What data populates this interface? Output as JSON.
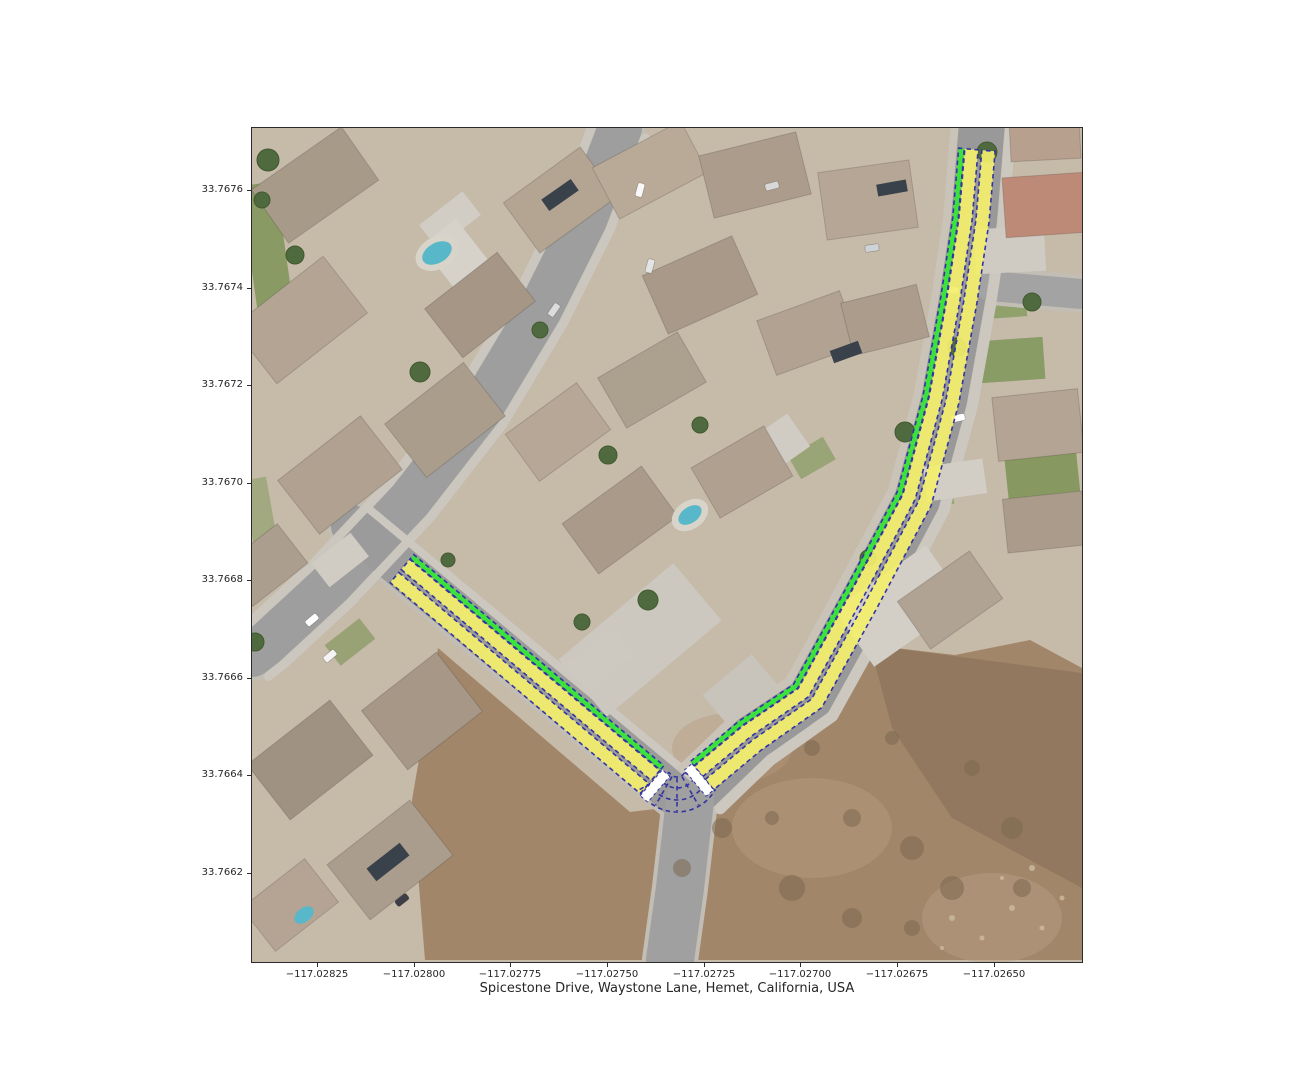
{
  "title": {
    "text": "Spicestone Drive, Waystone Lane, Hemet, California, USA"
  },
  "map": {
    "left": 252,
    "top": 128,
    "width": 830,
    "height": 834
  },
  "axes": {
    "tick_len": 4,
    "x_ticks": [
      {
        "px": 65,
        "label": "−117.02825"
      },
      {
        "px": 162,
        "label": "−117.02800"
      },
      {
        "px": 258,
        "label": "−117.02775"
      },
      {
        "px": 355,
        "label": "−117.02750"
      },
      {
        "px": 452,
        "label": "−117.02725"
      },
      {
        "px": 548,
        "label": "−117.02700"
      },
      {
        "px": 645,
        "label": "−117.02675"
      },
      {
        "px": 742,
        "label": "−117.02650"
      }
    ],
    "y_ticks": [
      {
        "px": 62,
        "label": "33.7676"
      },
      {
        "px": 159.5,
        "label": "33.7674"
      },
      {
        "px": 257,
        "label": "33.7672"
      },
      {
        "px": 354.5,
        "label": "33.7670"
      },
      {
        "px": 452,
        "label": "33.7668"
      },
      {
        "px": 549.5,
        "label": "33.7666"
      },
      {
        "px": 647,
        "label": "33.7664"
      },
      {
        "px": 744.5,
        "label": "33.7662"
      }
    ]
  },
  "scene": {
    "base": "#c6baa9",
    "lawns": [
      {
        "cx": 17,
        "cy": 135,
        "w": 36,
        "h": 160,
        "rot": -8,
        "c": "#7e9458",
        "op": 0.85
      },
      {
        "cx": 10,
        "cy": 395,
        "w": 24,
        "h": 90,
        "rot": -10,
        "c": "#8a9c64",
        "op": 0.6
      },
      {
        "cx": 760,
        "cy": 232,
        "w": 64,
        "h": 42,
        "rot": -4,
        "c": "#82995e",
        "op": 0.9
      },
      {
        "cx": 790,
        "cy": 344,
        "w": 72,
        "h": 46,
        "rot": -6,
        "c": "#7f9659",
        "op": 0.9
      },
      {
        "cx": 748,
        "cy": 172,
        "w": 52,
        "h": 36,
        "rot": -4,
        "c": "#869c62",
        "op": 0.85
      },
      {
        "cx": 676,
        "cy": 364,
        "w": 48,
        "h": 32,
        "rot": -10,
        "c": "#8aa066",
        "op": 0.8
      },
      {
        "cx": 98,
        "cy": 514,
        "w": 44,
        "h": 26,
        "rot": -38,
        "c": "#84995f",
        "op": 0.7
      },
      {
        "cx": 560,
        "cy": 330,
        "w": 40,
        "h": 26,
        "rot": -30,
        "c": "#879d62",
        "op": 0.7
      }
    ],
    "dirt": {
      "main": [
        [
          186,
          520
        ],
        [
          378,
          684
        ],
        [
          438,
          677
        ],
        [
          493,
          620
        ],
        [
          546,
          572
        ],
        [
          618,
          517
        ],
        [
          703,
          527
        ],
        [
          778,
          512
        ],
        [
          830,
          540
        ],
        [
          830,
          832
        ],
        [
          173,
          832
        ],
        [
          160,
          672
        ]
      ],
      "color": "#a2866a",
      "dark_overlay": {
        "pts": [
          [
            618,
            517
          ],
          [
            830,
            545
          ],
          [
            830,
            760
          ],
          [
            700,
            690
          ],
          [
            640,
            600
          ]
        ],
        "c": "#7c6950",
        "op": 0.45
      },
      "washes": [
        {
          "cx": 560,
          "cy": 700,
          "rx": 80,
          "ry": 50,
          "c": "#b49a7c",
          "op": 0.5
        },
        {
          "cx": 480,
          "cy": 620,
          "rx": 60,
          "ry": 35,
          "c": "#b49a7c",
          "op": 0.4
        },
        {
          "cx": 740,
          "cy": 790,
          "rx": 70,
          "ry": 45,
          "c": "#b7a084",
          "op": 0.45
        }
      ]
    },
    "streets": [
      {
        "pts": [
          [
            368,
            0
          ],
          [
            333,
            92
          ],
          [
            288,
            182
          ],
          [
            228,
            282
          ],
          [
            158,
            372
          ],
          [
            78,
            457
          ],
          [
            13,
            517
          ],
          [
            0,
            527
          ]
        ],
        "w": 44,
        "c": "#9e9e9e"
      },
      {
        "pts": [
          [
            100,
            398
          ],
          [
            425,
            668
          ]
        ],
        "w": 42,
        "c": "#9b9b9b"
      },
      {
        "pts": [
          [
            448,
            660
          ],
          [
            500,
            610
          ],
          [
            558,
            570
          ],
          [
            612,
            472
          ],
          [
            665,
            372
          ],
          [
            692,
            272
          ],
          [
            710,
            172
          ],
          [
            722,
            92
          ],
          [
            730,
            -6
          ]
        ],
        "w": 46,
        "c": "#999999"
      },
      {
        "pts": [
          [
            438,
            672
          ],
          [
            428,
            760
          ],
          [
            418,
            832
          ]
        ],
        "w": 48,
        "c": "#a0a0a0"
      },
      {
        "pts": [
          [
            738,
            158
          ],
          [
            830,
            166
          ]
        ],
        "w": 30,
        "c": "#a3a3a3"
      }
    ],
    "sidewalks": [
      {
        "street": 0,
        "off": 27,
        "w": 9,
        "c": "#cbc7bf"
      },
      {
        "street": 0,
        "off": -27,
        "w": 9,
        "c": "#cbc7bf"
      },
      {
        "street": 1,
        "off": 24,
        "w": 8,
        "c": "#ccc8c0"
      },
      {
        "street": 2,
        "off": -29,
        "w": 11,
        "c": "#ccc8c0"
      },
      {
        "street": 2,
        "off": 27,
        "w": 8,
        "c": "#c9c3b8"
      }
    ],
    "pads": [
      {
        "cx": 388,
        "cy": 512,
        "w": 150,
        "h": 75,
        "rot": -40,
        "c": "#ccc8c0"
      },
      {
        "cx": 488,
        "cy": 562,
        "w": 64,
        "h": 40,
        "rot": -40,
        "c": "#c8c4bc"
      },
      {
        "cx": 518,
        "cy": 322,
        "w": 70,
        "h": 40,
        "rot": -35,
        "c": "#d0ccc4"
      },
      {
        "cx": 703,
        "cy": 352,
        "w": 60,
        "h": 35,
        "rot": -8,
        "c": "#d2cec6"
      },
      {
        "cx": 758,
        "cy": 122,
        "w": 70,
        "h": 45,
        "rot": -3,
        "c": "#cfcbc3"
      },
      {
        "cx": 648,
        "cy": 478,
        "w": 112,
        "h": 70,
        "rot": -35,
        "c": "#d3cfc7"
      },
      {
        "cx": 88,
        "cy": 432,
        "w": 50,
        "h": 30,
        "rot": -38,
        "c": "#d0ccc4"
      },
      {
        "cx": 198,
        "cy": 92,
        "w": 55,
        "h": 30,
        "rot": -38,
        "c": "#d1cdc5"
      },
      {
        "cx": 348,
        "cy": 532,
        "w": 60,
        "h": 35,
        "rot": -40,
        "c": "#cdc9c1"
      },
      {
        "cx": 205,
        "cy": 128,
        "w": 44,
        "h": 60,
        "rot": -38,
        "c": "#d6d2ca"
      }
    ],
    "houses": [
      {
        "cx": 63,
        "cy": 57,
        "w": 110,
        "h": 65,
        "rot": -35,
        "c": "#a89a89"
      },
      {
        "cx": 48,
        "cy": 192,
        "w": 115,
        "h": 72,
        "rot": -38,
        "c": "#b3a493"
      },
      {
        "cx": 193,
        "cy": 292,
        "w": 100,
        "h": 68,
        "rot": -38,
        "c": "#ab9d8c"
      },
      {
        "cx": 88,
        "cy": 347,
        "w": 105,
        "h": 68,
        "rot": -38,
        "c": "#b0a190"
      },
      {
        "cx": 228,
        "cy": 177,
        "w": 92,
        "h": 62,
        "rot": -38,
        "c": "#a59685"
      },
      {
        "cx": 308,
        "cy": 72,
        "w": 95,
        "h": 62,
        "rot": -36,
        "c": "#b4a593"
      },
      {
        "cx": 398,
        "cy": 42,
        "w": 100,
        "h": 58,
        "rot": -28,
        "c": "#b9aa98"
      },
      {
        "cx": 503,
        "cy": 47,
        "w": 100,
        "h": 64,
        "rot": -14,
        "c": "#ab9c8b"
      },
      {
        "cx": 616,
        "cy": 72,
        "w": 92,
        "h": 68,
        "rot": -8,
        "c": "#b5a695"
      },
      {
        "cx": 448,
        "cy": 157,
        "w": 98,
        "h": 64,
        "rot": -24,
        "c": "#a89988"
      },
      {
        "cx": 556,
        "cy": 205,
        "w": 88,
        "h": 58,
        "rot": -20,
        "c": "#b1a291"
      },
      {
        "cx": 400,
        "cy": 252,
        "w": 92,
        "h": 58,
        "rot": -30,
        "c": "#aca08f"
      },
      {
        "cx": 306,
        "cy": 304,
        "w": 88,
        "h": 58,
        "rot": -36,
        "c": "#b7a796"
      },
      {
        "cx": 368,
        "cy": 392,
        "w": 98,
        "h": 62,
        "rot": -36,
        "c": "#a99a8a"
      },
      {
        "cx": 490,
        "cy": 344,
        "w": 84,
        "h": 58,
        "rot": -30,
        "c": "#b0a090"
      },
      {
        "cx": 633,
        "cy": 192,
        "w": 78,
        "h": 54,
        "rot": -14,
        "c": "#ab9c8c"
      },
      {
        "cx": 793,
        "cy": 77,
        "w": 82,
        "h": 60,
        "rot": -4,
        "c": "#bd8a78"
      },
      {
        "cx": 793,
        "cy": 12,
        "w": 70,
        "h": 40,
        "rot": -3,
        "c": "#b7a08e"
      },
      {
        "cx": 786,
        "cy": 297,
        "w": 86,
        "h": 64,
        "rot": -6,
        "c": "#b3a493"
      },
      {
        "cx": 793,
        "cy": 394,
        "w": 80,
        "h": 54,
        "rot": -6,
        "c": "#aa9b8b"
      },
      {
        "cx": 698,
        "cy": 472,
        "w": 88,
        "h": 58,
        "rot": -35,
        "c": "#b1a394"
      },
      {
        "cx": 58,
        "cy": 632,
        "w": 105,
        "h": 70,
        "rot": -38,
        "c": "#a09282"
      },
      {
        "cx": 138,
        "cy": 732,
        "w": 105,
        "h": 70,
        "rot": -38,
        "c": "#ab9d8d"
      },
      {
        "cx": 38,
        "cy": 777,
        "w": 80,
        "h": 55,
        "rot": -38,
        "c": "#b5a494"
      },
      {
        "cx": 170,
        "cy": 583,
        "w": 95,
        "h": 75,
        "rot": -38,
        "c": "#a69787"
      },
      {
        "cx": 13,
        "cy": 437,
        "w": 70,
        "h": 50,
        "rot": -38,
        "c": "#ac9e8e"
      }
    ],
    "panels": [
      {
        "cx": 136,
        "cy": 734,
        "w": 42,
        "h": 16,
        "rot": -38
      },
      {
        "cx": 594,
        "cy": 224,
        "w": 30,
        "h": 13,
        "rot": -20
      },
      {
        "cx": 308,
        "cy": 67,
        "w": 36,
        "h": 14,
        "rot": -35
      },
      {
        "cx": 640,
        "cy": 60,
        "w": 30,
        "h": 12,
        "rot": -10
      }
    ],
    "panel_color": "#39414b",
    "pools": [
      {
        "cx": 185,
        "cy": 125,
        "rx": 16,
        "ry": 10,
        "rot": -30,
        "deck": true
      },
      {
        "cx": 438,
        "cy": 387,
        "rx": 13,
        "ry": 8,
        "rot": -35,
        "deck": true
      },
      {
        "cx": 52,
        "cy": 787,
        "rx": 11,
        "ry": 7,
        "rot": -38,
        "deck": false
      }
    ],
    "pool_color": "#58b7c9",
    "deck_color": "#d8d4ca",
    "trees": [
      {
        "cx": 16,
        "cy": 32,
        "r": 11
      },
      {
        "cx": 43,
        "cy": 127,
        "r": 9
      },
      {
        "cx": 168,
        "cy": 244,
        "r": 10
      },
      {
        "cx": 288,
        "cy": 202,
        "r": 8
      },
      {
        "cx": 356,
        "cy": 327,
        "r": 9
      },
      {
        "cx": 448,
        "cy": 297,
        "r": 8
      },
      {
        "cx": 396,
        "cy": 472,
        "r": 10
      },
      {
        "cx": 330,
        "cy": 494,
        "r": 8
      },
      {
        "cx": 653,
        "cy": 304,
        "r": 10
      },
      {
        "cx": 705,
        "cy": 219,
        "r": 9
      },
      {
        "cx": 735,
        "cy": 24,
        "r": 10
      },
      {
        "cx": 780,
        "cy": 174,
        "r": 9
      },
      {
        "cx": 616,
        "cy": 430,
        "r": 8
      },
      {
        "cx": 3,
        "cy": 514,
        "r": 9
      },
      {
        "cx": 196,
        "cy": 432,
        "r": 7
      },
      {
        "cx": 10,
        "cy": 72,
        "r": 8
      }
    ],
    "tree_color": "#4f6a3e",
    "bushes": [
      {
        "cx": 470,
        "cy": 700,
        "r": 10
      },
      {
        "cx": 540,
        "cy": 760,
        "r": 13
      },
      {
        "cx": 600,
        "cy": 690,
        "r": 9
      },
      {
        "cx": 660,
        "cy": 720,
        "r": 12
      },
      {
        "cx": 720,
        "cy": 640,
        "r": 8
      },
      {
        "cx": 760,
        "cy": 700,
        "r": 11
      },
      {
        "cx": 560,
        "cy": 620,
        "r": 8
      },
      {
        "cx": 640,
        "cy": 610,
        "r": 7
      },
      {
        "cx": 700,
        "cy": 760,
        "r": 12
      },
      {
        "cx": 770,
        "cy": 760,
        "r": 9
      },
      {
        "cx": 520,
        "cy": 690,
        "r": 7
      },
      {
        "cx": 600,
        "cy": 790,
        "r": 10
      },
      {
        "cx": 660,
        "cy": 800,
        "r": 8
      },
      {
        "cx": 430,
        "cy": 740,
        "r": 9
      }
    ],
    "bush_color": "#7b684f",
    "rocks": [
      {
        "cx": 700,
        "cy": 790,
        "r": 3
      },
      {
        "cx": 730,
        "cy": 810,
        "r": 2.5
      },
      {
        "cx": 760,
        "cy": 780,
        "r": 3
      },
      {
        "cx": 790,
        "cy": 800,
        "r": 2.5
      },
      {
        "cx": 690,
        "cy": 820,
        "r": 2
      },
      {
        "cx": 780,
        "cy": 740,
        "r": 3
      },
      {
        "cx": 810,
        "cy": 770,
        "r": 2.5
      },
      {
        "cx": 750,
        "cy": 750,
        "r": 2
      }
    ],
    "rock_color": "#cdbb9f",
    "cars": [
      {
        "cx": 388,
        "cy": 62,
        "rot": -75,
        "c": "#f8f8f8"
      },
      {
        "cx": 398,
        "cy": 138,
        "rot": -75,
        "c": "#e4e4e4"
      },
      {
        "cx": 302,
        "cy": 182,
        "rot": -55,
        "c": "#dcdcdc"
      },
      {
        "cx": 60,
        "cy": 492,
        "rot": -40,
        "c": "#ffffff"
      },
      {
        "cx": 706,
        "cy": 290,
        "rot": -12,
        "c": "#ffffff"
      },
      {
        "cx": 700,
        "cy": 162,
        "rot": 5,
        "c": "#e8e8e8"
      },
      {
        "cx": 150,
        "cy": 772,
        "rot": -38,
        "c": "#3c4046"
      },
      {
        "cx": 78,
        "cy": 528,
        "rot": -40,
        "c": "#f4f4f4"
      },
      {
        "cx": 520,
        "cy": 58,
        "rot": -15,
        "c": "#d8d8d8"
      },
      {
        "cx": 620,
        "cy": 120,
        "rot": -8,
        "c": "#cfd3d6"
      }
    ]
  },
  "route": {
    "style": {
      "lane_fill": "#f3ef6c",
      "lane_opacity": 0.92,
      "edge_green": "#3ce23c",
      "dash_color": "#3434a2",
      "dash_width": 1.6,
      "dash_array": "4.5 3.5",
      "stop_bar_fill": "#ffffff"
    },
    "geometry": {
      "half_gap": 1.9,
      "lane_out": 15.2,
      "green_in": 15.8,
      "green_out": 21.4
    },
    "segments": [
      {
        "name": "waystone-lane",
        "pts": [
          [
            148,
            443
          ],
          [
            398,
            654
          ]
        ]
      },
      {
        "name": "spicestone-drive",
        "pts": [
          [
            452,
            650
          ],
          [
            500,
            610
          ],
          [
            558,
            570
          ],
          [
            612,
            472
          ],
          [
            665,
            372
          ],
          [
            692,
            272
          ],
          [
            710,
            172
          ],
          [
            722,
            92
          ],
          [
            728,
            22
          ]
        ]
      }
    ],
    "stop_bars": [
      {
        "cx": 403,
        "cy": 658,
        "len": 34,
        "thick": 10,
        "rot": -49.5
      },
      {
        "cx": 447,
        "cy": 652,
        "len": 34,
        "thick": 10,
        "rot": 50.2
      }
    ],
    "fan": {
      "cx": 425,
      "cy": 640,
      "r_in": 9,
      "r_out": 44,
      "a1": 30,
      "a2": 150,
      "mid_arcs": [
        20,
        32
      ],
      "radials": [
        60,
        90,
        120
      ]
    }
  }
}
